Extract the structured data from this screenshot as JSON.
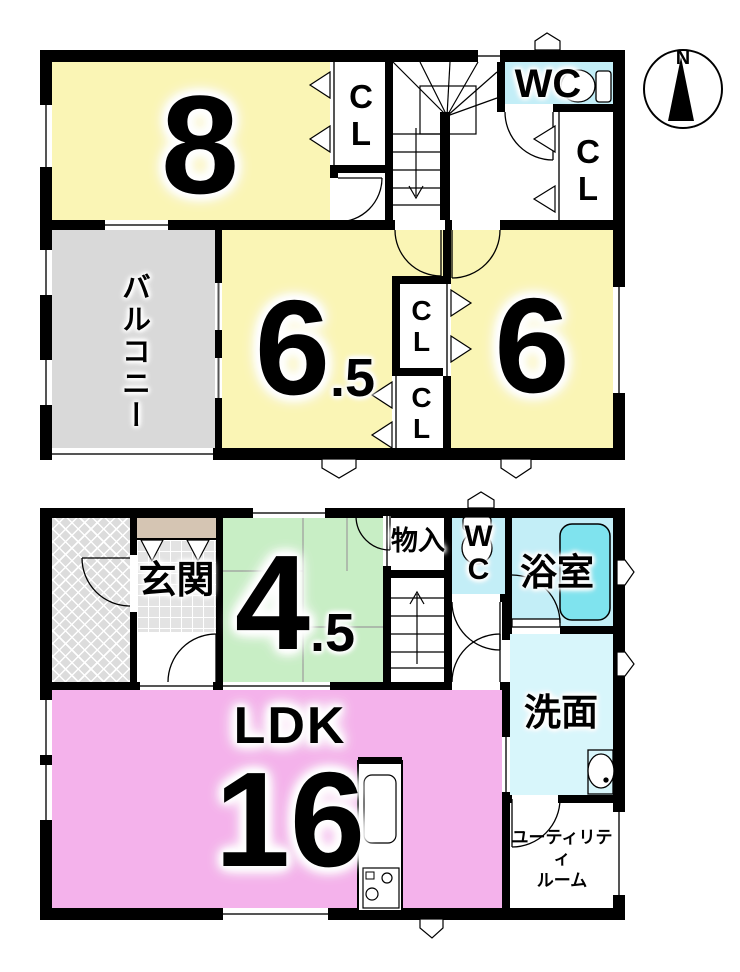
{
  "compass": {
    "label": "N"
  },
  "colors": {
    "wall": "#000000",
    "yellow": "#FAF5B5",
    "gray": "#D9D9D9",
    "green": "#C8EEC5",
    "pink": "#F4B2EB",
    "cyan": "#C3EEF7",
    "cyan_light": "#D8F6FB",
    "tile": "#E3E3E3",
    "cabinet": "#D5C5B3",
    "bathtub": "#7FE3EE"
  },
  "floor2": {
    "room8": {
      "label": "8"
    },
    "closet_a": {
      "label": "CL"
    },
    "wc": {
      "label": "WC"
    },
    "closet_b": {
      "label": "CL"
    },
    "balcony": {
      "label": "バルコニー"
    },
    "room65": {
      "size": "6",
      "fraction": ".5"
    },
    "closet_c": {
      "label": "CL"
    },
    "closet_d": {
      "label": "CL"
    },
    "room6": {
      "label": "6"
    }
  },
  "floor1": {
    "genkan": {
      "label": "玄関"
    },
    "room45": {
      "size": "4",
      "fraction": ".5"
    },
    "monoire": {
      "label": "物入"
    },
    "wc": {
      "label": "WC"
    },
    "bath": {
      "label": "浴室"
    },
    "senmen": {
      "label": "洗面"
    },
    "ldk": {
      "name": "LDK",
      "size": "16"
    },
    "utility": {
      "label": "ユーティリティ\nルーム"
    }
  }
}
